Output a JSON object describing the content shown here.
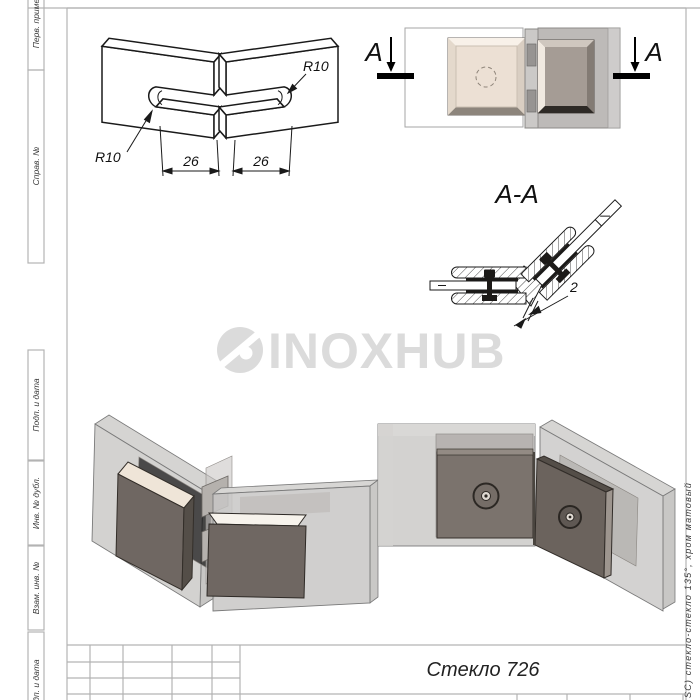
{
  "sheet": {
    "margin_labels": [
      "Перв. примен.",
      "Справ. №",
      "Подп. и дата",
      "Инв. № дубл.",
      "Взам. инв. №",
      "Подп. и дата"
    ],
    "side_note": "SC) стекло-стекло 135°, хром матовый",
    "title": "Стекло 726"
  },
  "views": {
    "iso": {
      "radius_left": "R10",
      "radius_right": "R10",
      "dim_left": "26",
      "dim_right": "26"
    },
    "top": {
      "section_letter_left": "А",
      "section_letter_right": "А"
    },
    "section": {
      "label": "А-А",
      "gap_dim": "2"
    }
  },
  "watermark": {
    "text": "INOXHUB"
  },
  "colors": {
    "frame_line": "#b3b3b3",
    "drawing_line": "#1a1a1a",
    "watermark_gray": "#dbdbdb",
    "clamp_cream": "#efe6db",
    "clamp_taupe": "#6f6762",
    "glass_gray": "#c4c3c1"
  }
}
